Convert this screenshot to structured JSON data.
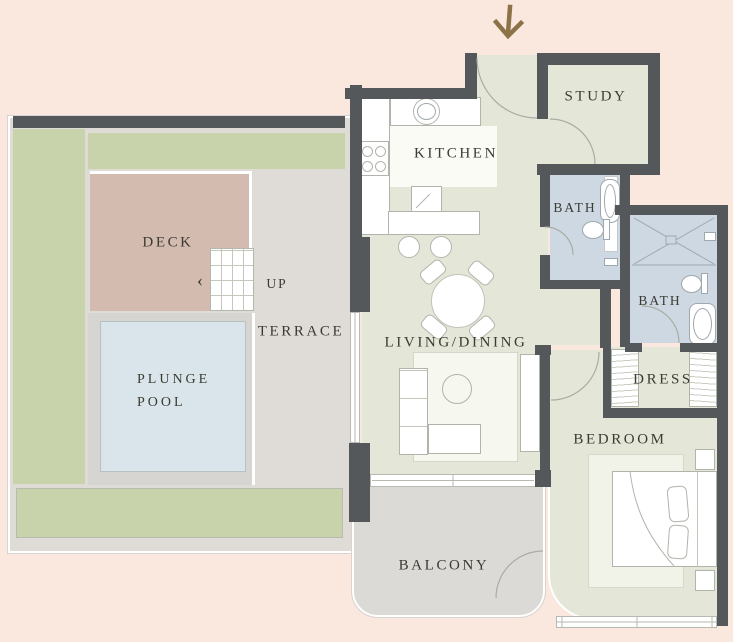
{
  "floorplan": {
    "labels": {
      "kitchen": "KITCHEN",
      "study": "STUDY",
      "bath_upper": "BATH",
      "bath_lower": "BATH",
      "dress": "DRESS",
      "bedroom": "BEDROOM",
      "living_dining": "LIVING/DINING",
      "balcony": "BALCONY",
      "terrace": "TERRACE",
      "deck": "DECK",
      "up": "UP",
      "plunge_pool_line1": "PLUNGE",
      "plunge_pool_line2": "POOL",
      "stairs_chevron": "‹"
    },
    "colors": {
      "background": "#fae7dd",
      "walls": "#54585a",
      "interior_floor": "#e4e6d7",
      "bathroom_floor": "#cdd8e2",
      "terrace_floor": "#dfdcd8",
      "greenery": "#c9d3ab",
      "deck": "#d4bbb0",
      "plunge_pool": "#d9e5ea",
      "balcony_floor": "#dcdad6",
      "furniture": "#ffffff",
      "entrance_arrow": "#8c7347"
    }
  }
}
